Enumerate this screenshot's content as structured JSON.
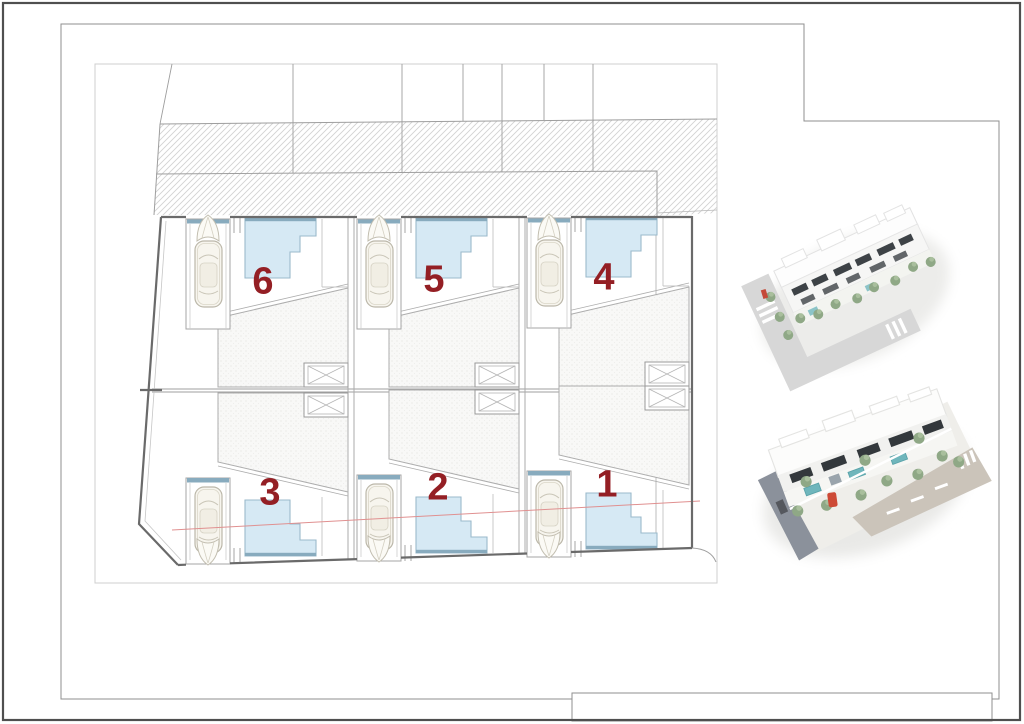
{
  "sheet": {
    "kind": "architectural site plan sheet",
    "background": "#ffffff"
  },
  "colors": {
    "unit_number": "#941f24",
    "pool_fill": "#d6e9f4",
    "pool_edge": "#9bbacb",
    "pool_dark_edge": "#88abbe",
    "road_hatch": "#d2d2d2",
    "parcel_outline": "#6a6a6a",
    "detail_line": "#a8a8a8",
    "section_line": "#e09090",
    "frame": "#8f8f8f",
    "outer_border": "#4f4f4f",
    "render_green": "#8fa886",
    "render_road_grey": "#d7d7d7",
    "render_dark_road": "#8b919b",
    "render_pool_teal": "#6fb6bc",
    "render_window_dark": "#383d41",
    "render_car_red": "#cd4a36"
  },
  "site_plan": {
    "units": [
      {
        "id": "unit-1",
        "number": "1"
      },
      {
        "id": "unit-2",
        "number": "2"
      },
      {
        "id": "unit-3",
        "number": "3"
      },
      {
        "id": "unit-4",
        "number": "4"
      },
      {
        "id": "unit-5",
        "number": "5"
      },
      {
        "id": "unit-6",
        "number": "6"
      }
    ]
  },
  "renders": [
    {
      "id": "aerial-render-top",
      "description": "3D aerial view of white two-storey residences with corner street, crossings and landscaping"
    },
    {
      "id": "aerial-render-bottom",
      "description": "3D aerial close-up with terraces, pools, trees, red car and road"
    }
  ]
}
